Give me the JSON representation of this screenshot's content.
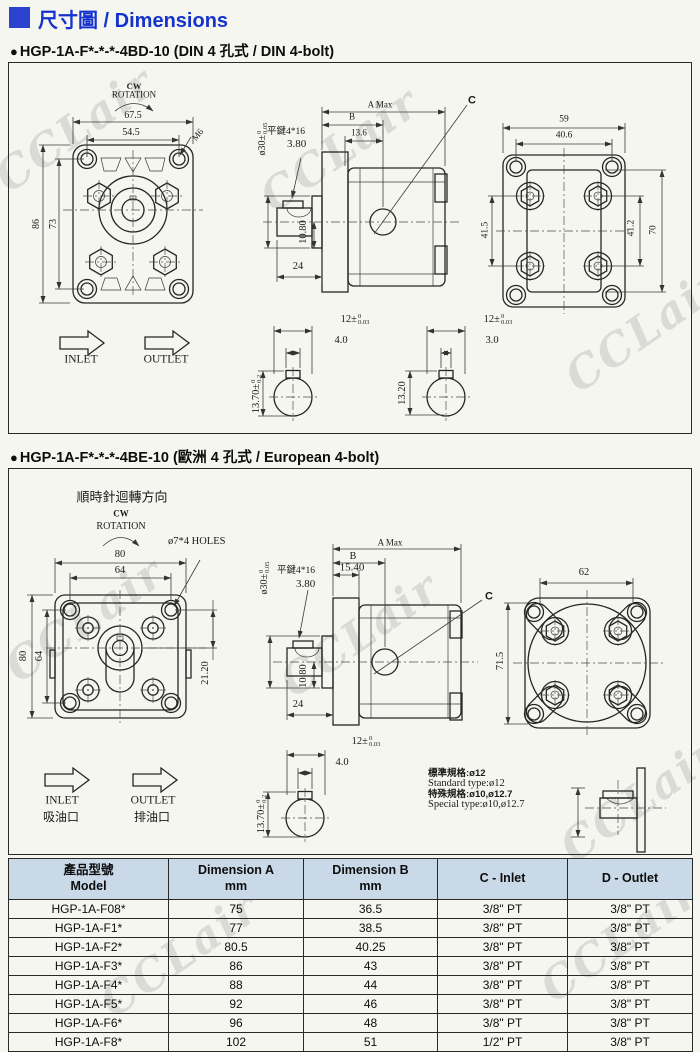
{
  "page": {
    "watermark": "CCLair"
  },
  "header": {
    "title": "尺寸圖 / Dimensions"
  },
  "section1": {
    "bullet": "●",
    "title": "HGP-1A-F*-*-*-4BD-10 (DIN 4 孔式 / DIN 4-bolt)",
    "front": {
      "cw": "CW",
      "rotation": "ROTATION",
      "w_outer": "67.5",
      "w_inner": "54.5",
      "h_outer": "86",
      "h_inner": "73",
      "bolt": "M6",
      "inlet": "INLET",
      "outlet": "OUTLET"
    },
    "side": {
      "a_max": "A Max",
      "b": "B",
      "b_offset": "13.6",
      "key": "平鍵4*16",
      "key_height": "3.80",
      "shaft_offset": "10.80",
      "shaft_len": "24",
      "port_label": "C"
    },
    "shaft_main": {
      "key_width": "4.0"
    },
    "shaft_alt": {
      "key_width": "3.0",
      "flat_height": "13.20"
    },
    "rear": {
      "w_outer": "59",
      "w_inner": "40.6",
      "h_left": "41.5",
      "h_right": "41.2",
      "h_outer": "70"
    }
  },
  "section2": {
    "bullet": "●",
    "title": "HGP-1A-F*-*-*-4BE-10 (歐洲 4 孔式 / European 4-bolt)",
    "front": {
      "cw_zh": "順時針迴轉方向",
      "cw": "CW",
      "rotation": "ROTATION",
      "w_outer": "80",
      "w_inner": "64",
      "h_outer": "80",
      "h_inner": "64",
      "holes": "ø7*4 HOLES",
      "hole_offset": "21.20"
    },
    "side": {
      "a_max": "A Max",
      "b": "B",
      "flange_thick": "15.40",
      "key": "平鍵4*16",
      "key_height": "3.80",
      "shaft_offset": "10.80",
      "shaft_len": "24",
      "port_label": "C"
    },
    "shaft": {
      "key_width": "4.0"
    },
    "spec": {
      "zh_standard": "標準規格:ø12",
      "en_standard": "Standard type:ø12",
      "zh_special": "特殊規格:ø10,ø12.7",
      "en_special": "Special type:ø10,ø12.7"
    },
    "rear": {
      "w_outer": "62",
      "h_outer": "71.5"
    },
    "ports": {
      "inlet": "INLET",
      "inlet_zh": "吸油口",
      "outlet": "OUTLET",
      "outlet_zh": "排油口"
    }
  },
  "dims": {
    "d12": {
      "base": "12±",
      "top": "0",
      "bot": "0.03"
    },
    "d1370": {
      "base": "13.70±",
      "top": "0",
      "bot": "0.2"
    },
    "d30": {
      "base": "ø30±",
      "top": "0",
      "bot": "0.05"
    }
  },
  "table": {
    "header_bg": "#c9d9e8",
    "headers": {
      "model_zh": "產品型號",
      "model_en": "Model",
      "dim_a1": "Dimension A",
      "dim_a2": "mm",
      "dim_b1": "Dimension B",
      "dim_b2": "mm",
      "c": "C - Inlet",
      "d": "D - Outlet"
    },
    "rows": [
      {
        "model": "HGP-1A-F08*",
        "a": "75",
        "b": "36.5",
        "c": "3/8\" PT",
        "d": "3/8\" PT"
      },
      {
        "model": "HGP-1A-F1*",
        "a": "77",
        "b": "38.5",
        "c": "3/8\" PT",
        "d": "3/8\" PT"
      },
      {
        "model": "HGP-1A-F2*",
        "a": "80.5",
        "b": "40.25",
        "c": "3/8\" PT",
        "d": "3/8\" PT"
      },
      {
        "model": "HGP-1A-F3*",
        "a": "86",
        "b": "43",
        "c": "3/8\" PT",
        "d": "3/8\" PT"
      },
      {
        "model": "HGP-1A-F4*",
        "a": "88",
        "b": "44",
        "c": "3/8\" PT",
        "d": "3/8\" PT"
      },
      {
        "model": "HGP-1A-F5*",
        "a": "92",
        "b": "46",
        "c": "3/8\" PT",
        "d": "3/8\" PT"
      },
      {
        "model": "HGP-1A-F6*",
        "a": "96",
        "b": "48",
        "c": "3/8\" PT",
        "d": "3/8\" PT"
      },
      {
        "model": "HGP-1A-F8*",
        "a": "102",
        "b": "51",
        "c": "1/2\" PT",
        "d": "3/8\" PT"
      }
    ]
  }
}
